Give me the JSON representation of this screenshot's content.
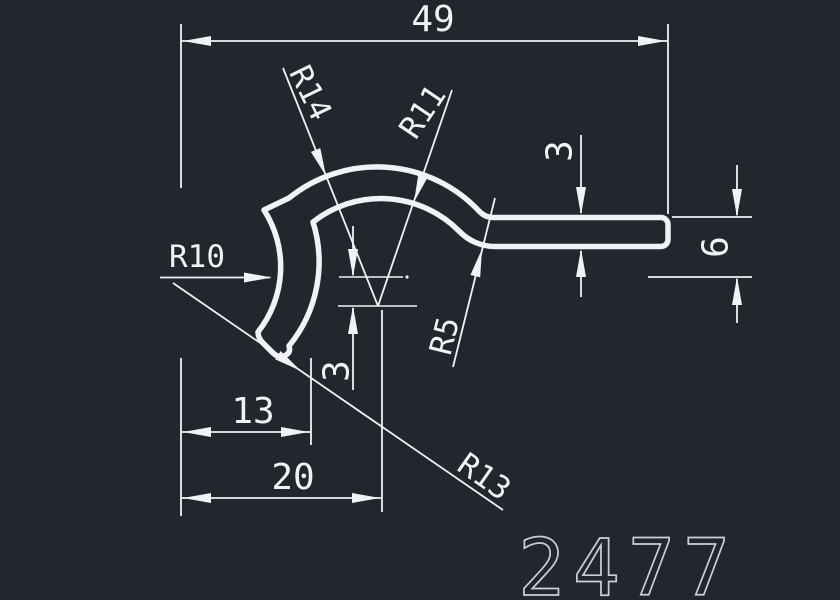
{
  "drawing": {
    "colors": {
      "background": "#22262d",
      "line": "#f0f2f5",
      "part_number": "#c9cfd7"
    },
    "part_number": "2477",
    "dimensions": {
      "overall_width": "49",
      "bar_thickness": "3",
      "right_drop": "6",
      "center_offset": "3",
      "hook_width": "13",
      "center_width": "20"
    },
    "radii": {
      "outer_arch": "R14",
      "inner_arch": "R11",
      "hook_outer": "R10",
      "bar_fillet": "R5",
      "hook_inner": "R13"
    }
  }
}
